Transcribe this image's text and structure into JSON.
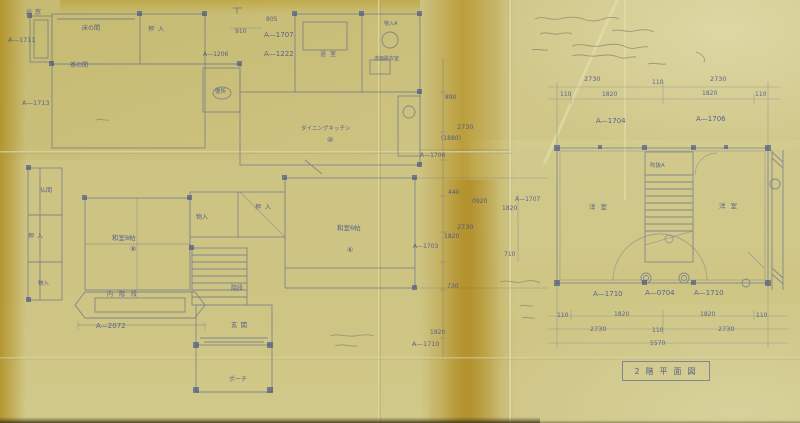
{
  "meta": {
    "description": "Scanned hand-drawn Japanese architectural floor plan blueprint on yellowed, fold-creased paper",
    "sheet_title": "2階平面図"
  },
  "palette": {
    "paper": "#cdc383",
    "stain": "#b0901f",
    "ink_blue": "#3e4d8d",
    "pencil": "#8f8b70"
  },
  "title_block": {
    "text": "2階平面図"
  },
  "floors": {
    "first_floor": {
      "rooms": [
        "出窓",
        "床の間",
        "押入",
        "茶の間",
        "仏間",
        "和室8帖",
        "物入",
        "押入",
        "和室6帖",
        "便所",
        "浴室",
        "洗面脱衣室",
        "物入A",
        "ダイニングキッチン",
        "階段",
        "内階段",
        "玄関",
        "ポーチ"
      ],
      "room_tags": [
        "⑧",
        "⑥",
        "⑩"
      ],
      "reference_codes": [
        "A—1711",
        "A—1713",
        "A—1206",
        "A—1707",
        "A—1222",
        "A—2072",
        "A—1703",
        "A—1710",
        "A—1706",
        "A—1707"
      ],
      "dimensions_mm": [
        "910",
        "805",
        "890",
        "2730",
        "(1880)",
        "440",
        "0920",
        "1820",
        "2730",
        "1820",
        "710",
        "730",
        "1820"
      ]
    },
    "second_floor": {
      "rooms": [
        "洋室",
        "洋室",
        "吹抜A"
      ],
      "reference_codes": [
        "A—1704",
        "A—1706",
        "A—1710",
        "A—0704",
        "A—1710"
      ],
      "dimensions_mm": [
        "2730",
        "110",
        "2730",
        "110",
        "1820",
        "1820",
        "110",
        "5570"
      ]
    }
  },
  "labels": [
    {
      "n": "room-label-demado",
      "t": "出窓",
      "x": 26,
      "y": 10,
      "s": 6,
      "sp": 3
    },
    {
      "n": "room-label-tokonoma",
      "t": "床の間",
      "x": 82,
      "y": 26,
      "s": 6
    },
    {
      "n": "room-label-oshiire-top",
      "t": "押入",
      "x": 148,
      "y": 27,
      "s": 6,
      "sp": 4
    },
    {
      "n": "ref-code-a1711",
      "t": "A—1711",
      "x": 8,
      "y": 37,
      "s": 6.5
    },
    {
      "n": "room-label-chanoma",
      "t": "茶の間",
      "x": 70,
      "y": 63,
      "s": 6
    },
    {
      "n": "ref-code-a1713",
      "t": "A—1713",
      "x": 22,
      "y": 100,
      "s": 6.5
    },
    {
      "n": "room-label-butsuma",
      "t": "仏間",
      "x": 40,
      "y": 188,
      "s": 6
    },
    {
      "n": "room-label-oshiire-left",
      "t": "押入",
      "x": 28,
      "y": 234,
      "s": 6,
      "sp": 3
    },
    {
      "n": "room-label-washitsu8",
      "t": "和室8帖",
      "x": 112,
      "y": 235,
      "s": 6.5
    },
    {
      "n": "room-tag-washitsu8",
      "t": "⑧",
      "x": 130,
      "y": 246,
      "s": 7
    },
    {
      "n": "room-label-monoire-bl",
      "t": "物入",
      "x": 38,
      "y": 282,
      "s": 5.5
    },
    {
      "n": "room-label-uchikaidan",
      "t": "内階段",
      "x": 107,
      "y": 292,
      "s": 6,
      "sp": 6
    },
    {
      "n": "ref-code-a2072",
      "t": "A—2072",
      "x": 96,
      "y": 323,
      "s": 7
    },
    {
      "n": "room-label-kaidan",
      "t": "階段",
      "x": 231,
      "y": 286,
      "s": 6
    },
    {
      "n": "room-label-genkan",
      "t": "玄関",
      "x": 231,
      "y": 322,
      "s": 6.5,
      "sp": 3
    },
    {
      "n": "room-label-porch",
      "t": "ポーチ",
      "x": 229,
      "y": 377,
      "s": 6
    },
    {
      "n": "room-label-benjo",
      "t": "便所",
      "x": 215,
      "y": 90,
      "s": 5.5
    },
    {
      "n": "ref-code-a1206",
      "t": "A—1206",
      "x": 203,
      "y": 52,
      "s": 6
    },
    {
      "n": "dim-910",
      "t": "910",
      "x": 235,
      "y": 29,
      "s": 6
    },
    {
      "n": "dim-805",
      "t": "805",
      "x": 266,
      "y": 17,
      "s": 6
    },
    {
      "n": "ref-code-a1707-top",
      "t": "A—1707",
      "x": 264,
      "y": 32,
      "s": 7
    },
    {
      "n": "ref-code-a1222",
      "t": "A—1222",
      "x": 264,
      "y": 51,
      "s": 7
    },
    {
      "n": "room-label-yokushitsu",
      "t": "浴室",
      "x": 320,
      "y": 52,
      "s": 6,
      "sp": 4
    },
    {
      "n": "room-label-monoire-a",
      "t": "物入A",
      "x": 384,
      "y": 22,
      "s": 5
    },
    {
      "n": "room-label-senmen",
      "t": "洗面脱衣室",
      "x": 374,
      "y": 57,
      "s": 5
    },
    {
      "n": "room-label-dk",
      "t": "ダイニングキッチン",
      "x": 301,
      "y": 127,
      "s": 5.5
    },
    {
      "n": "room-tag-dk",
      "t": "⑩",
      "x": 327,
      "y": 137,
      "s": 7
    },
    {
      "n": "room-label-oshiire-mid",
      "t": "押入",
      "x": 255,
      "y": 205,
      "s": 6,
      "sp": 4
    },
    {
      "n": "room-label-monoire-mid",
      "t": "物入",
      "x": 196,
      "y": 215,
      "s": 6
    },
    {
      "n": "room-label-washitsu6",
      "t": "和室6帖",
      "x": 337,
      "y": 225,
      "s": 6.5
    },
    {
      "n": "room-tag-washitsu6",
      "t": "⑥",
      "x": 347,
      "y": 247,
      "s": 7
    },
    {
      "n": "dim-890",
      "t": "890",
      "x": 445,
      "y": 95,
      "s": 6
    },
    {
      "n": "dim-2730-c1",
      "t": "2730",
      "x": 457,
      "y": 124,
      "s": 6.5
    },
    {
      "n": "dim-1880",
      "t": "(1880)",
      "x": 441,
      "y": 136,
      "s": 6
    },
    {
      "n": "ref-code-a1706-mid",
      "t": "A—1706",
      "x": 420,
      "y": 153,
      "s": 6
    },
    {
      "n": "dim-440",
      "t": "440",
      "x": 448,
      "y": 190,
      "s": 6
    },
    {
      "n": "dim-0920",
      "t": "0920",
      "x": 472,
      "y": 199,
      "s": 6
    },
    {
      "n": "dim-1820-c1",
      "t": "1820",
      "x": 502,
      "y": 206,
      "s": 6
    },
    {
      "n": "ref-code-a1707-mid",
      "t": "A—1707",
      "x": 515,
      "y": 197,
      "s": 6
    },
    {
      "n": "dim-2730-c2",
      "t": "2730",
      "x": 457,
      "y": 224,
      "s": 6.5
    },
    {
      "n": "dim-1820-c2",
      "t": "1820",
      "x": 444,
      "y": 234,
      "s": 6
    },
    {
      "n": "ref-code-a1703",
      "t": "A—1703",
      "x": 413,
      "y": 244,
      "s": 6
    },
    {
      "n": "dim-710",
      "t": "710",
      "x": 504,
      "y": 252,
      "s": 6
    },
    {
      "n": "dim-730",
      "t": "730",
      "x": 447,
      "y": 284,
      "s": 6
    },
    {
      "n": "dim-1820-c3",
      "t": "1820",
      "x": 430,
      "y": 330,
      "s": 6
    },
    {
      "n": "ref-code-a1710-mid",
      "t": "A—1710",
      "x": 412,
      "y": 341,
      "s": 6.5
    },
    {
      "n": "dim-2730-t1",
      "t": "2730",
      "x": 584,
      "y": 76,
      "s": 6.5
    },
    {
      "n": "dim-110-t",
      "t": "110",
      "x": 652,
      "y": 80,
      "s": 6
    },
    {
      "n": "dim-2730-t2",
      "t": "2730",
      "x": 710,
      "y": 76,
      "s": 6.5
    },
    {
      "n": "dim-110-t1",
      "t": "110",
      "x": 560,
      "y": 92,
      "s": 6
    },
    {
      "n": "dim-1820-t1",
      "t": "1820",
      "x": 602,
      "y": 92,
      "s": 6
    },
    {
      "n": "dim-1820-t2",
      "t": "1820",
      "x": 702,
      "y": 91,
      "s": 6
    },
    {
      "n": "dim-110-t2",
      "t": "110",
      "x": 755,
      "y": 92,
      "s": 6
    },
    {
      "n": "ref-code-a1704",
      "t": "A—1704",
      "x": 596,
      "y": 118,
      "s": 7
    },
    {
      "n": "ref-code-a1706",
      "t": "A—1706",
      "x": 696,
      "y": 116,
      "s": 7
    },
    {
      "n": "room-label-fukinuke",
      "t": "吹抜A",
      "x": 650,
      "y": 164,
      "s": 5.5
    },
    {
      "n": "room-label-yoshitsu-left",
      "t": "洋室",
      "x": 589,
      "y": 204,
      "s": 6.5,
      "sp": 5
    },
    {
      "n": "room-label-yoshitsu-right",
      "t": "洋室",
      "x": 719,
      "y": 203,
      "s": 6.5,
      "sp": 5
    },
    {
      "n": "ref-code-a1710-b1",
      "t": "A—1710",
      "x": 593,
      "y": 291,
      "s": 7
    },
    {
      "n": "ref-code-a0704",
      "t": "A—0704",
      "x": 645,
      "y": 290,
      "s": 7
    },
    {
      "n": "ref-code-a1710-b2",
      "t": "A—1710",
      "x": 694,
      "y": 290,
      "s": 7
    },
    {
      "n": "dim-110-b1",
      "t": "110",
      "x": 557,
      "y": 313,
      "s": 6
    },
    {
      "n": "dim-1820-b1",
      "t": "1820",
      "x": 614,
      "y": 312,
      "s": 6
    },
    {
      "n": "dim-1820-b2",
      "t": "1820",
      "x": 700,
      "y": 312,
      "s": 6
    },
    {
      "n": "dim-110-b2",
      "t": "110",
      "x": 756,
      "y": 313,
      "s": 6
    },
    {
      "n": "dim-2730-b1",
      "t": "2730",
      "x": 590,
      "y": 326,
      "s": 6.5
    },
    {
      "n": "dim-110-b3",
      "t": "110",
      "x": 652,
      "y": 328,
      "s": 6
    },
    {
      "n": "dim-2730-b2",
      "t": "2730",
      "x": 718,
      "y": 326,
      "s": 6.5
    },
    {
      "n": "dim-total-5570",
      "t": "5570",
      "x": 650,
      "y": 341,
      "s": 6
    }
  ]
}
